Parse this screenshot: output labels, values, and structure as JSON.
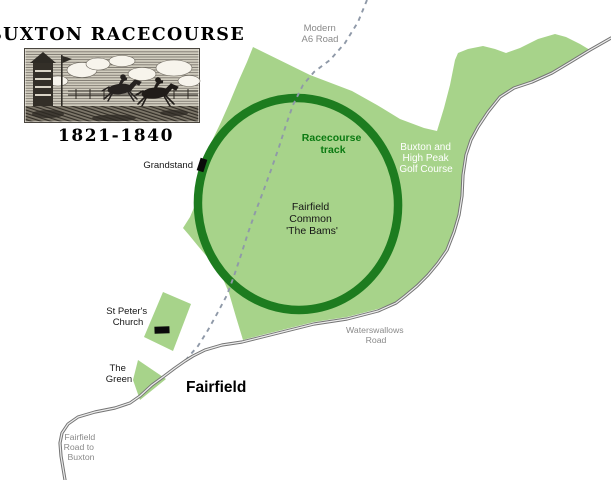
{
  "header": {
    "title": "BUXTON RACECOURSE",
    "period": "1821-1840",
    "illustration": "horse-race-woodcut-engraving"
  },
  "map": {
    "labels": {
      "modern_a6": {
        "lines": [
          "Modern",
          "A6 Road"
        ]
      },
      "racecourse_track": {
        "lines": [
          "Racecourse",
          "track"
        ]
      },
      "golf_course": {
        "lines": [
          "Buxton and",
          "High Peak",
          "Golf Course"
        ]
      },
      "fairfield_common": {
        "lines": [
          "Fairfield",
          "Common",
          "'The Bams'"
        ]
      },
      "grandstand": "Grandstand",
      "waterswallows": {
        "lines": [
          "Waterswallows",
          "Road"
        ]
      },
      "st_peters": {
        "lines": [
          "St Peter's",
          "Church"
        ]
      },
      "the_green": {
        "lines": [
          "The",
          "Green"
        ]
      },
      "fairfield_town": "Fairfield",
      "fairfield_road": {
        "lines": [
          "Fairfield",
          "Road to",
          "Buxton"
        ]
      }
    },
    "colors": {
      "land": "#a7d38a",
      "track": "#1d7c1f",
      "track_label": "#0b7a12",
      "golf_label": "#ffffff",
      "road_casing": "#747474",
      "road_center": "#ededed",
      "dashed": "#8f99a8",
      "muted": "#8a8a8a",
      "ink": "#151515",
      "title_ink": "#000000"
    }
  }
}
